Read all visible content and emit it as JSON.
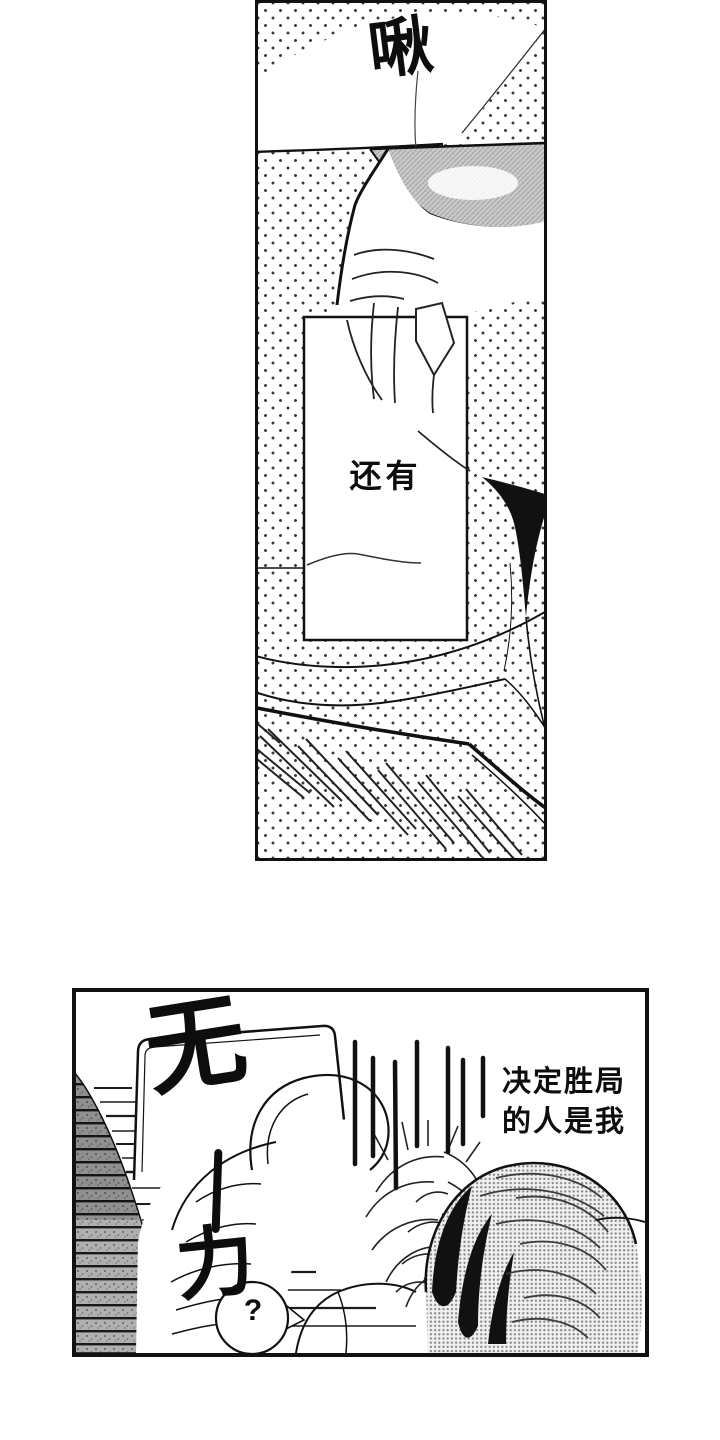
{
  "page": {
    "type": "manga-page",
    "colors": {
      "paper": "#ffffff",
      "ink": "#111111",
      "halftone_dot": "#3a3a3a",
      "shade_gray": "#cdcdcd",
      "hair_tone": "#858585",
      "wall_tone": "#b0b0b0"
    }
  },
  "panel_top": {
    "sfx_kiss": "啾",
    "caption": "还有"
  },
  "panel_bottom": {
    "sfx_impact": {
      "char1": "无",
      "dash": "ー",
      "char2": "力",
      "full": "无ー力"
    },
    "dialogue": {
      "line1": "决定胜局",
      "line2": "的人是我"
    },
    "bubble_text": "?"
  }
}
